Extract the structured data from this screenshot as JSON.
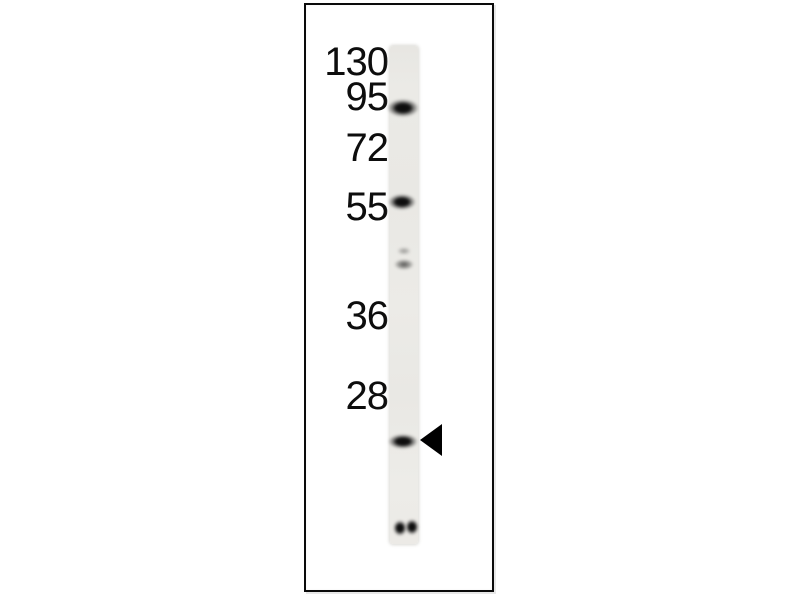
{
  "blot": {
    "markers": [
      {
        "label": "130"
      },
      {
        "label": "95"
      },
      {
        "label": "72"
      },
      {
        "label": "55"
      },
      {
        "label": "36"
      },
      {
        "label": "28"
      }
    ],
    "lane": {
      "x": 390,
      "y": 46,
      "width": 28,
      "height": 498
    },
    "bands": [
      {
        "name": "band-at-95-marker",
        "intensity": "strong",
        "x": 403,
        "y": 108,
        "w": 32,
        "h": 18
      },
      {
        "name": "band-at-55-marker",
        "intensity": "strong",
        "x": 402,
        "y": 202,
        "w": 28,
        "h": 16
      },
      {
        "name": "band-doublet-upper",
        "intensity": "faint",
        "x": 404,
        "y": 251,
        "w": 14,
        "h": 8
      },
      {
        "name": "band-doublet-lower",
        "intensity": "medium",
        "x": 404,
        "y": 264,
        "w": 20,
        "h": 11
      },
      {
        "name": "band-target-arrow-marked",
        "intensity": "strong",
        "x": 403,
        "y": 441,
        "w": 30,
        "h": 15
      },
      {
        "name": "band-bottom-left",
        "intensity": "strong",
        "x": 400,
        "y": 528,
        "w": 14,
        "h": 16
      },
      {
        "name": "band-bottom-right",
        "intensity": "strong",
        "x": 412,
        "y": 527,
        "w": 14,
        "h": 16
      }
    ],
    "arrow": {
      "glyph": "left-pointing-filled-triangle",
      "points_to": "band-target-arrow-marked"
    },
    "colors": {
      "background": "#ffffff",
      "frame_border": "#0a0a0a",
      "text": "#0d0d0d",
      "lane": "#eae9e5",
      "band_dark": "#111111",
      "arrow": "#000000"
    }
  }
}
